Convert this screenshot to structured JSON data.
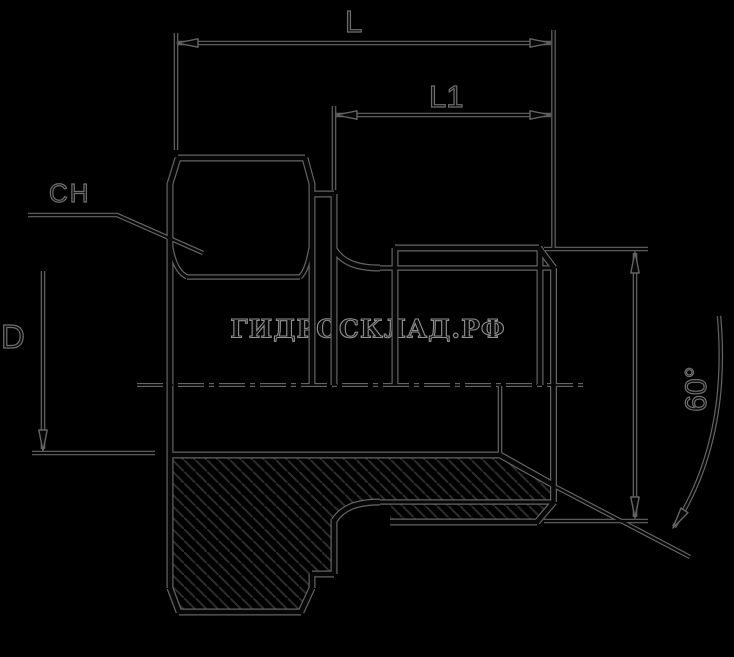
{
  "page": {
    "width": 734,
    "height": 657,
    "background": "#000000",
    "description": "Technical dimension drawing (half-section) of a male-threaded hydraulic adapter fitting with hex flats"
  },
  "watermark": {
    "text": "ГИДРОСКЛАД.РФ"
  },
  "labels": {
    "overall_length": "L",
    "thread_length": "L1",
    "hex_size": "CH",
    "diameter": "D",
    "cone_angle": "60°"
  },
  "colors": {
    "background": "#000000",
    "line_core": "#070707",
    "line_halo": "#646464",
    "hatch_line": "#2d2d2d"
  },
  "drawing": {
    "thick_paths": [
      "M 178 158 L 305 158",
      "M 178 158 L 170 184",
      "M 305 158 L 312 184",
      "M 170 183 L 170 588",
      "M 170 588 L 179 612",
      "M 179 612 L 301 612",
      "M 301 612 L 312 588",
      "M 312 183 L 312 385",
      "M 312 574 L 312 588",
      "M 313 194 L 334 194",
      "M 334 194 L 334 385",
      "M 334 519 L 334 574",
      "M 312 574 L 334 574",
      "M 334 249 C 342 262 356 268 380 268",
      "M 334 521 C 342 508 356 502 380 502",
      "M 395 248 L 539 248",
      "M 395 248 L 395 385",
      "M 390 522 L 537 522",
      "M 539 248 L 554 268",
      "M 537 522 L 554 502",
      "M 540 248 L 540 385",
      "M 553.5 268 L 553.5 502",
      "M 170 455 L 500 455",
      "M 500 455 L 553.5 485"
    ],
    "medium_paths": [
      "M 187 277 L 300 277",
      "M 171 248 Q 175 271 187 277",
      "M 311 248 Q 307 271 300 277",
      "M 380 268 L 553 268",
      "M 380 502 L 551 502"
    ],
    "thin_paths": [
      "M 177 43 L 551 43",
      "M 176 33 L 176 150",
      "M 553.5 30 L 553.5 250",
      "M 336 115 L 551 115",
      "M 334 106 L 334 190",
      "M 43 271 L 43 449",
      "M 32 453 L 155 453",
      "M 28 215 L 117 215 L 203 253",
      "M 544 249 L 648 249",
      "M 544 521 L 648 521",
      "M 635 253 L 635 517",
      "M 556 487 L 690 557",
      "M 719 316 Q 730 440 674 527",
      "M 500 386 L 500 455"
    ],
    "centerline": {
      "path": "M 137 385 L 583 385",
      "dash": "26 5 5 5"
    },
    "hatch": {
      "outline": "M 170 455 L 500 455 L 553 485 L 553 502 L 537 522 L 390 522 L 390 502 L 380 502 C 356 502 342 508 334 521 L 334 574 L 312 574 L 312 588 L 301 612 L 179 612 L 170 588 Z",
      "spacing": 11.5,
      "line_width": 2
    },
    "arrows": [
      {
        "x": 177,
        "y": 43,
        "angle": 180
      },
      {
        "x": 551,
        "y": 43,
        "angle": 0
      },
      {
        "x": 336,
        "y": 115,
        "angle": 180
      },
      {
        "x": 551,
        "y": 115,
        "angle": 0
      },
      {
        "x": 43,
        "y": 451,
        "angle": 90
      },
      {
        "x": 635,
        "y": 252,
        "angle": -90
      },
      {
        "x": 635,
        "y": 518,
        "angle": 90
      },
      {
        "x": 673,
        "y": 528,
        "angle": 123
      }
    ]
  }
}
